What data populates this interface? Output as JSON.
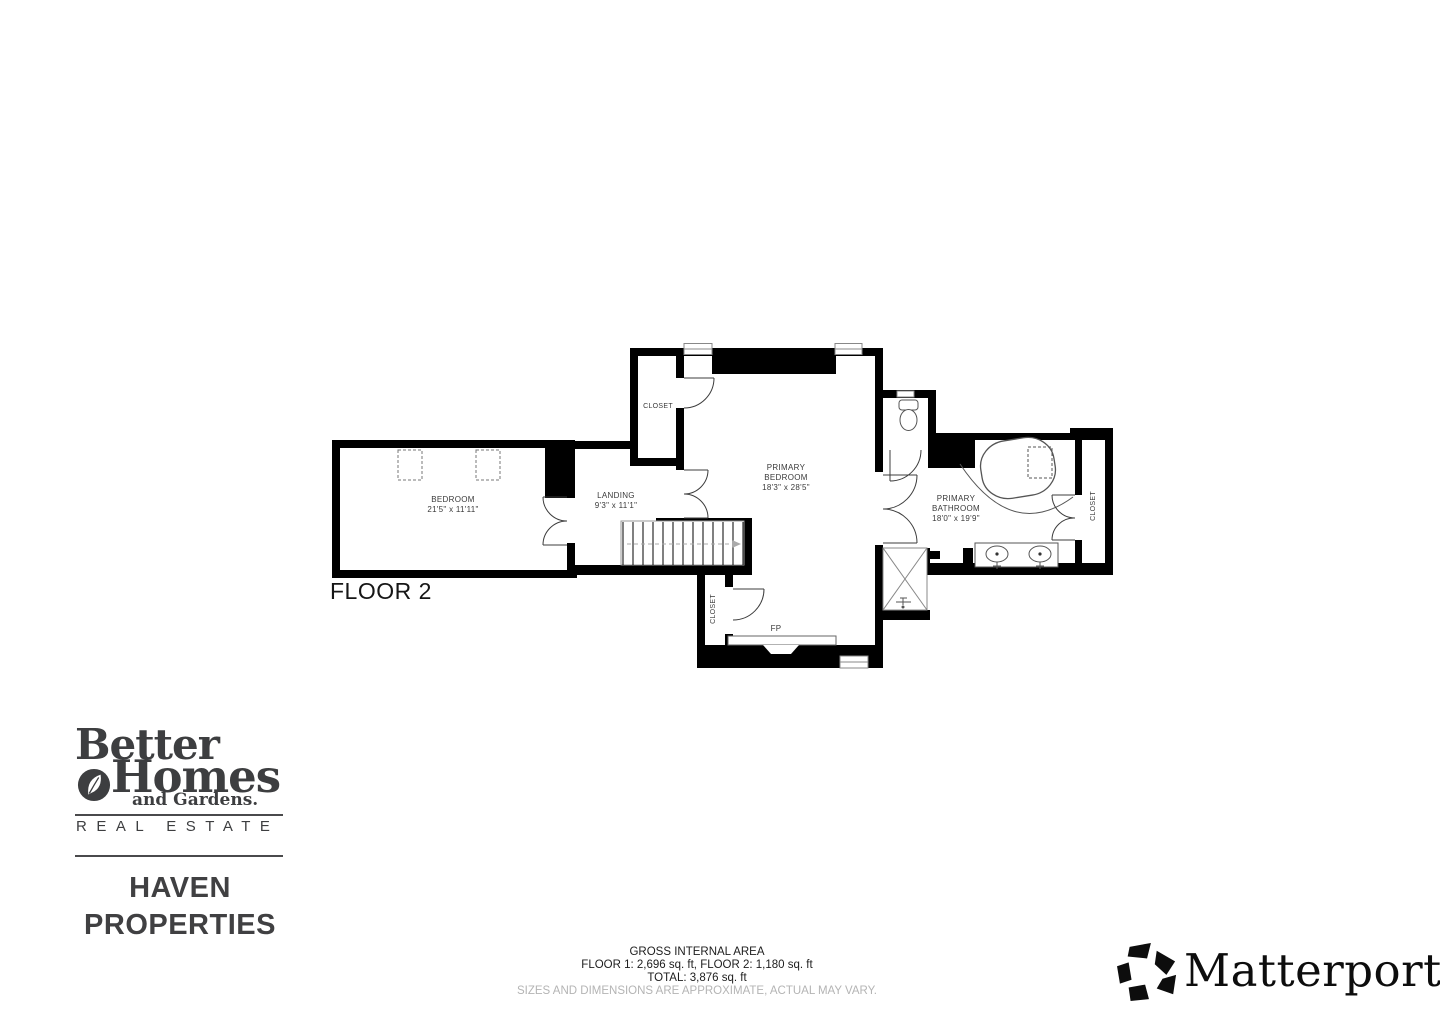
{
  "plan": {
    "floor_label": "FLOOR 2",
    "rooms": {
      "bedroom": {
        "name": "BEDROOM",
        "dims": "21'5\" x 11'11\""
      },
      "landing": {
        "name": "LANDING",
        "dims": "9'3\" x 11'1\""
      },
      "primary_bedroom": {
        "line1": "PRIMARY",
        "line2": "BEDROOM",
        "dims": "18'3\" x 28'5\""
      },
      "primary_bathroom": {
        "line1": "PRIMARY",
        "line2": "BATHROOM",
        "dims": "18'0\" x 19'9\""
      }
    },
    "labels": {
      "closet_top": "CLOSET",
      "closet_bottom": "CLOSET",
      "closet_right": "CLOSET",
      "fireplace": "FP"
    }
  },
  "footer": {
    "title": "GROSS INTERNAL AREA",
    "floors": "FLOOR 1: 2,696 sq. ft, FLOOR 2: 1,180 sq. ft",
    "total": "TOTAL: 3,876 sq. ft",
    "disclaimer": "SIZES AND DIMENSIONS ARE APPROXIMATE, ACTUAL MAY VARY."
  },
  "branding": {
    "better": "Better",
    "homes": "Homes",
    "and_gardens": "and Gardens.",
    "real_estate": "REAL ESTATE",
    "agency_line1": "HAVEN",
    "agency_line2": "PROPERTIES"
  },
  "matterport": {
    "wordmark": "Matterport",
    "registered": "®"
  },
  "colors": {
    "wall": "#000000",
    "plan_line": "#555555",
    "text_dark": "#1d1d1d",
    "logo_gray": "#3d3e40",
    "disclaimer_gray": "#b4b4b4"
  }
}
